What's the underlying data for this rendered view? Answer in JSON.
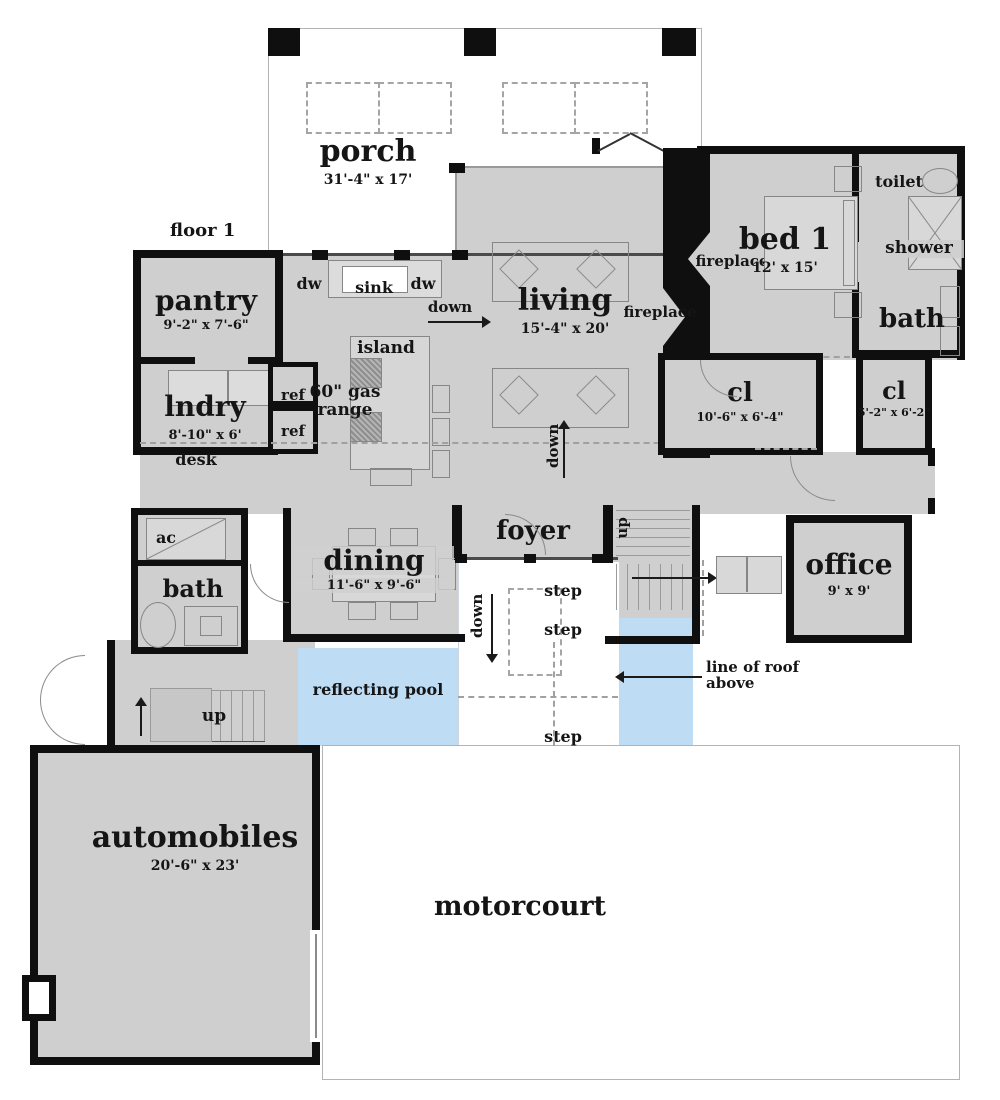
{
  "colors": {
    "wall": "#0f0f0f",
    "floor": "#cfcfcf",
    "pool": "#bedcf4",
    "porch_outline": "#b3b3b3",
    "annotation_text": "#151515"
  },
  "plan_meta": {
    "floor_label": "floor 1"
  },
  "rooms": {
    "porch": {
      "label": "porch",
      "dims": "31'-4\" x 17'"
    },
    "pantry": {
      "label": "pantry",
      "dims": "9'-2\" x 7'-6\""
    },
    "living": {
      "label": "living",
      "dims": "15'-4\" x 20'"
    },
    "bed1": {
      "label": "bed 1",
      "dims": "12' x 15'"
    },
    "toilet": {
      "label": "toilet"
    },
    "shower": {
      "label": "shower"
    },
    "bath_main": {
      "label": "bath"
    },
    "cl_large": {
      "label": "cl",
      "dims": "10'-6\" x 6'-4\""
    },
    "cl_small": {
      "label": "cl",
      "dims": "5'-2\" x 6'-2\""
    },
    "lndry": {
      "label": "lndry",
      "dims": "8'-10\" x 6'"
    },
    "dining": {
      "label": "dining",
      "dims": "11'-6\" x 9'-6\""
    },
    "foyer": {
      "label": "foyer"
    },
    "office": {
      "label": "office",
      "dims": "9' x 9'"
    },
    "ac": {
      "label": "ac"
    },
    "bath_left": {
      "label": "bath"
    },
    "pool": {
      "label": "reflecting pool"
    },
    "automobiles": {
      "label": "automobiles",
      "dims": "20'-6\" x 23'"
    },
    "motorcourt": {
      "label": "motorcourt"
    }
  },
  "fixtures": {
    "sink": "sink",
    "dw_left": "dw",
    "dw_right": "dw",
    "island": "island",
    "range": "60\" gas range",
    "ref_top": "ref",
    "ref_bottom": "ref",
    "desk": "desk",
    "fireplace_living": "fireplace",
    "fireplace_bed": "fireplace"
  },
  "annotations": {
    "down_kitchen": "down",
    "down_center": "down",
    "down_steps": "down",
    "up_stair": "up",
    "up_garage": "up",
    "step1": "step",
    "step2": "step",
    "step3": "step",
    "roof_line": "line of roof above"
  }
}
